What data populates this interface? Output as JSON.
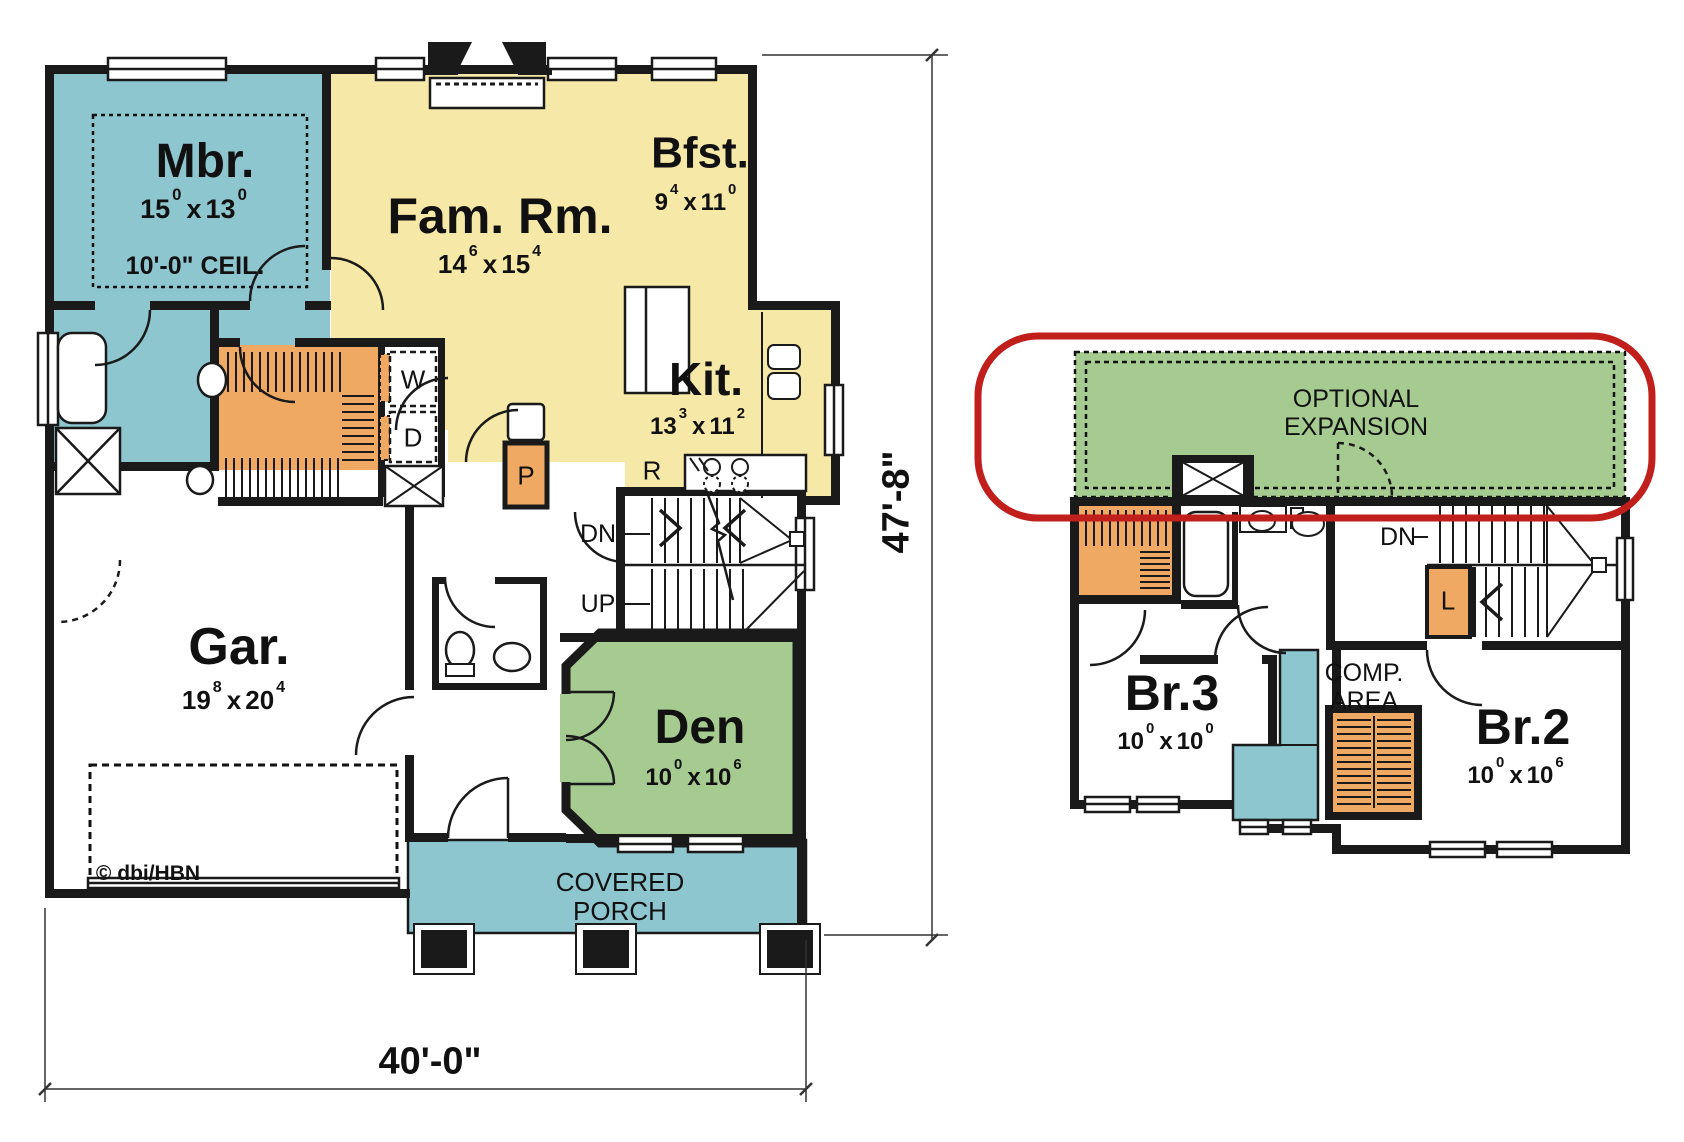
{
  "shared": {
    "dim_separator": "x"
  },
  "colors": {
    "room_blue": "#8EC6D0",
    "room_yellow": "#F6E8A6",
    "room_green": "#A6CB90",
    "closet_orange": "#F0A963",
    "wall_black": "#1A1A1A",
    "highlight_red": "#C01F1B",
    "line_dark": "#333333"
  },
  "first_floor": {
    "rooms": {
      "master_bedroom": {
        "name": "Mbr.",
        "dim_a": "15",
        "dim_a_sup": "0",
        "dim_b": "13",
        "dim_b_sup": "0",
        "ceiling_note": "10'-0\" CEIL."
      },
      "family_room": {
        "name": "Fam. Rm.",
        "dim_a": "14",
        "dim_a_sup": "6",
        "dim_b": "15",
        "dim_b_sup": "4"
      },
      "breakfast": {
        "name": "Bfst.",
        "dim_a": "9",
        "dim_a_sup": "4",
        "dim_b": "11",
        "dim_b_sup": "0"
      },
      "kitchen": {
        "name": "Kit.",
        "dim_a": "13",
        "dim_a_sup": "3",
        "dim_b": "11",
        "dim_b_sup": "2"
      },
      "garage": {
        "name": "Gar.",
        "dim_a": "19",
        "dim_a_sup": "8",
        "dim_b": "20",
        "dim_b_sup": "4"
      },
      "den": {
        "name": "Den",
        "dim_a": "10",
        "dim_a_sup": "0",
        "dim_b": "10",
        "dim_b_sup": "6"
      },
      "covered_porch": {
        "line1": "COVERED",
        "line2": "PORCH"
      }
    },
    "markers": {
      "washer": "W",
      "dryer": "D",
      "pantry": "P",
      "range": "R",
      "stairs_down": "DN",
      "stairs_up": "UP"
    },
    "copyright": "© dbi/HBN",
    "dimensions": {
      "overall_width": "40'-0\"",
      "overall_depth": "47'-8\""
    }
  },
  "second_floor": {
    "rooms": {
      "optional_expansion": {
        "line1": "OPTIONAL",
        "line2": "EXPANSION"
      },
      "bedroom_3": {
        "name": "Br.3",
        "dim_a": "10",
        "dim_a_sup": "0",
        "dim_b": "10",
        "dim_b_sup": "0"
      },
      "bedroom_2": {
        "name": "Br.2",
        "dim_a": "10",
        "dim_a_sup": "0",
        "dim_b": "10",
        "dim_b_sup": "6"
      },
      "computer_area": {
        "line1": "COMP.",
        "line2": "AREA"
      }
    },
    "markers": {
      "stairs_down": "DN",
      "linen": "L"
    }
  }
}
